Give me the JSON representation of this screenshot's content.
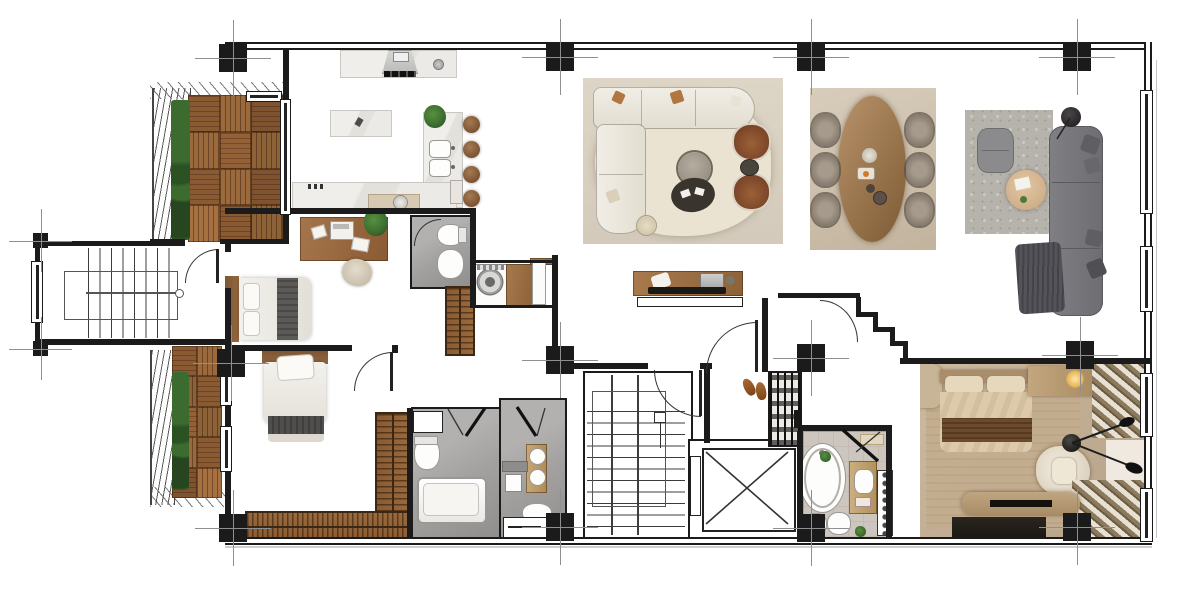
{
  "title": "apartment-floor-plan",
  "colors": {
    "wall": "#1b1b1b",
    "grid": "#8f8f8f",
    "deck1": "#8a5a33",
    "deck2": "#6e4426",
    "deckLight": "#9a6a3c",
    "plant": "#3c6b2f",
    "marble": "#eceae6",
    "woodMid": "#a87a4e",
    "woodDesk": "#9c6b40",
    "cream": "#eae3d2",
    "creamFloor": "#dbd3c4",
    "brownChair": "#8a5232",
    "diningWood": "#b08a5e",
    "graySofa": "#77767a",
    "grayThrow": "#55535a",
    "rugGray": "#b6b3ac",
    "bathFloor": "#a3a19f",
    "tileBeige": "#ccc6be",
    "photoBeige": "#c9b69d",
    "photoTan": "#b99b78",
    "photoDark": "#241f1a",
    "throwBrown": "#6b4a2e",
    "bedThrow": "#56544f"
  },
  "legend": {
    "rooms": [
      "entry-stairs",
      "upper-balcony",
      "lower-balcony",
      "kitchen",
      "study-bedroom",
      "wc",
      "laundry",
      "second-bedroom",
      "bathroom-tub",
      "bathroom-vanity",
      "hallway",
      "living-room",
      "dining-area",
      "lounge",
      "stairwell",
      "elevator-shaft",
      "master-bathroom",
      "master-bedroom"
    ],
    "furniture": [
      "kitchen-island",
      "bar-stools",
      "range-hood",
      "sectional-sofa",
      "coffee-tables",
      "armchairs",
      "tv-console",
      "dining-table",
      "dining-chairs",
      "gray-sofa",
      "pouf",
      "round-table",
      "floor-lamp",
      "desk",
      "beds",
      "wardrobes",
      "washer",
      "bathtub",
      "freestanding-tub",
      "double-vanity",
      "toilet",
      "bidet",
      "shoe-rack",
      "slippers",
      "bench",
      "radiator",
      "curtains",
      "fireplace-console"
    ]
  }
}
